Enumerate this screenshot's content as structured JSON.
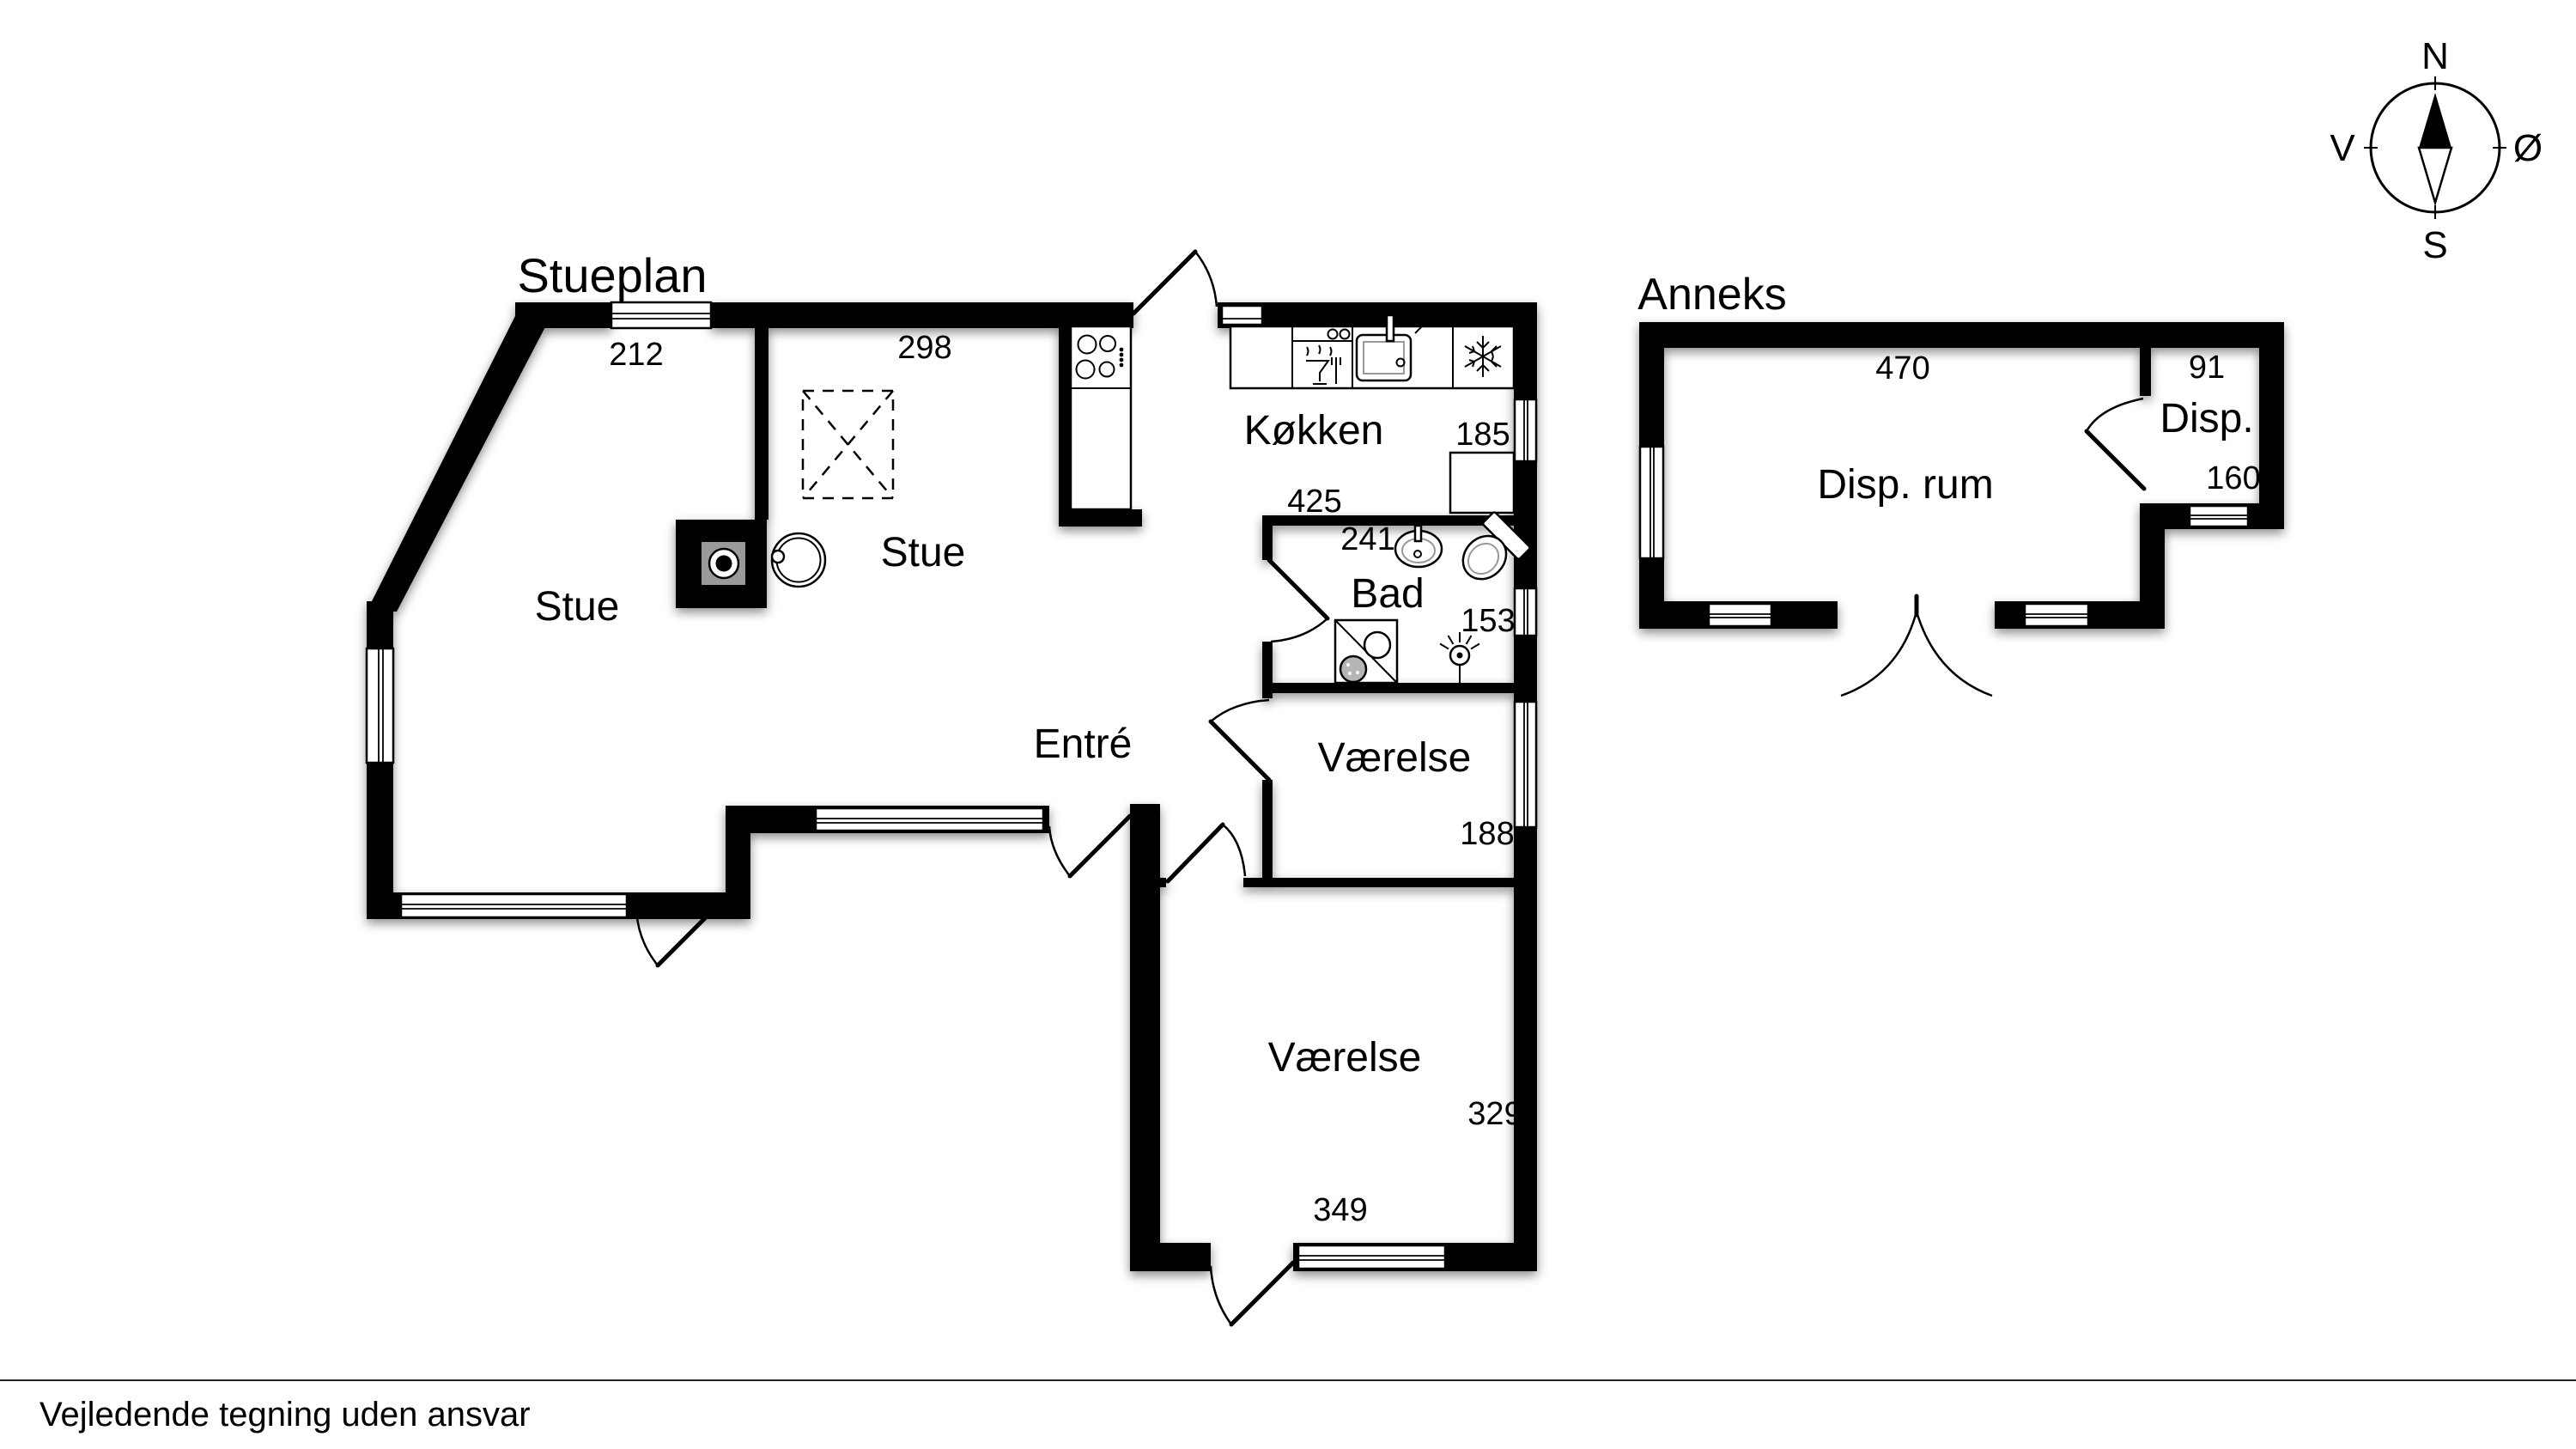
{
  "page": {
    "title": "Stueplan",
    "annex_title": "Anneks",
    "disclaimer": "Vejledende tegning uden ansvar"
  },
  "compass": {
    "north": "N",
    "south": "S",
    "east": "Ø",
    "west": "V"
  },
  "colors": {
    "wall": "#000000",
    "background": "#ffffff",
    "hearth_gray": "#9a9a9a",
    "fixture_gray": "#999999"
  },
  "rooms": {
    "stue_left": "Stue",
    "stue_right": "Stue",
    "koekken": "Køkken",
    "bad": "Bad",
    "entre": "Entré",
    "vaerelse_upper": "Værelse",
    "vaerelse_lower": "Værelse",
    "disp_rum": "Disp. rum",
    "disp": "Disp."
  },
  "dimensions_cm": {
    "stue_left_top": "212",
    "stue_right_top": "298",
    "koekken_width": "425",
    "bad_width": "241",
    "koekken_right": "185",
    "bad_right": "153",
    "vaerelse_upper_right": "188",
    "vaerelse_lower_right": "329",
    "vaerelse_lower_bottom": "349",
    "disp_rum_top": "470",
    "disp_top": "91",
    "disp_right": "160"
  },
  "icons": [
    "compass-rose-icon",
    "cooktop-icon",
    "dishwasher-icon",
    "kitchen-sink-icon",
    "freezer-snowflake-icon",
    "shower-cabinet-icon",
    "wash-basin-icon",
    "toilet-icon",
    "washing-machine-icon",
    "ceiling-lamp-icon",
    "fireplace-icon",
    "wood-stove-icon",
    "skylight-icon"
  ]
}
